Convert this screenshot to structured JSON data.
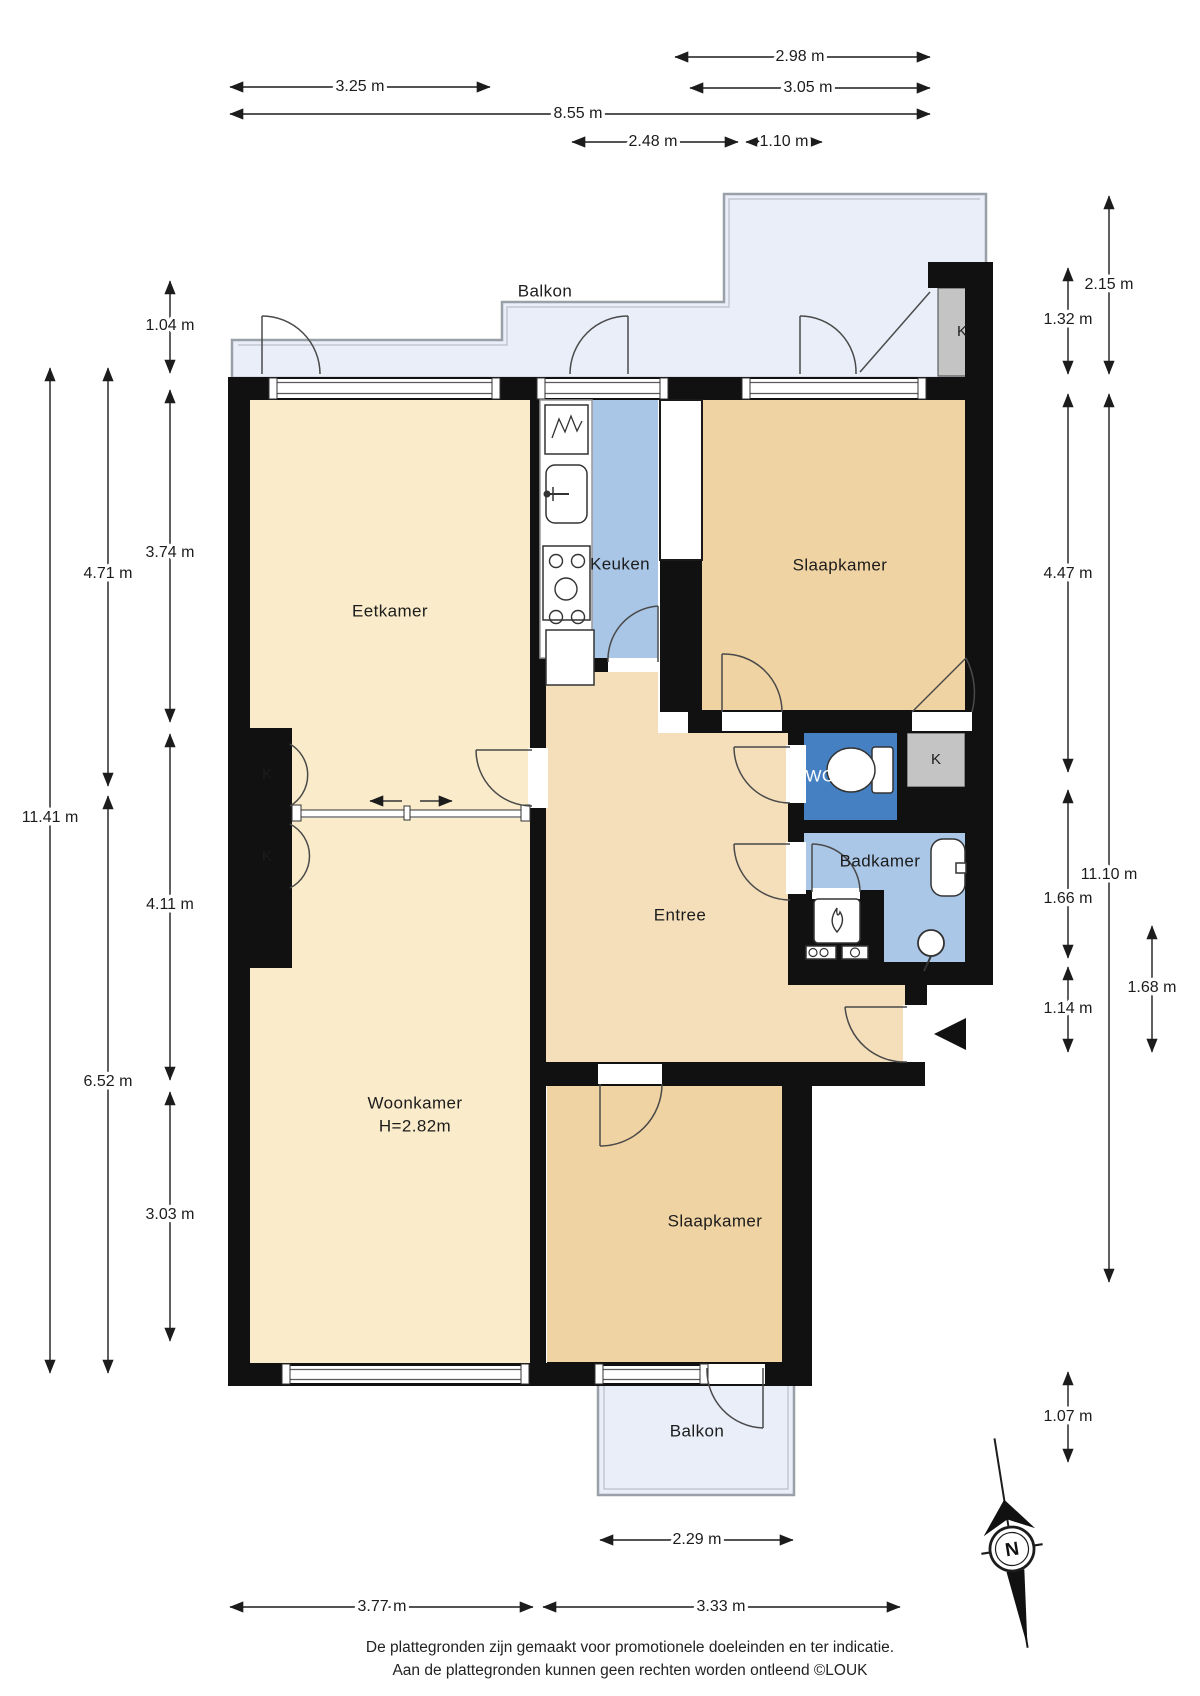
{
  "rooms": {
    "balkon_top": "Balkon",
    "eetkamer": "Eetkamer",
    "keuken": "Keuken",
    "slaapkamer_top": "Slaapkamer",
    "wc": "WC",
    "badkamer": "Badkamer",
    "entree": "Entree",
    "woonkamer": "Woonkamer",
    "woonkamer_height": "H=2.82m",
    "slaapkamer_bottom": "Slaapkamer",
    "balkon_bottom": "Balkon"
  },
  "closets": [
    "K",
    "K",
    "K",
    "K"
  ],
  "dimensions": {
    "top": [
      "2.98 m",
      "3.25 m",
      "3.05 m",
      "8.55 m",
      "2.48 m",
      "1.10 m"
    ],
    "left": [
      "1.04 m",
      "3.74 m",
      "4.71 m",
      "11.41 m",
      "4.11 m",
      "6.52 m",
      "3.03 m"
    ],
    "right": [
      "2.15 m",
      "1.32 m",
      "4.47 m",
      "11.10 m",
      "1.66 m",
      "1.14 m",
      "1.68 m",
      "1.07 m"
    ],
    "bottom": [
      "2.29 m",
      "3.77 m",
      "3.33 m"
    ]
  },
  "compass": {
    "north_label": "N"
  },
  "footer": {
    "line1": "De plattegronden zijn gemaakt voor promotionele doeleinden en ter indicatie.",
    "line2": "Aan de plattegronden kunnen geen rechten worden ontleend ©LOUK"
  },
  "colors": {
    "wall": "#111111",
    "living": "#faecca",
    "entree": "#f5dfbb",
    "bedroom": "#f0d3a2",
    "kitchen": "#a9c6e6",
    "bathroom": "#aac7e8",
    "wc": "#4581c2",
    "balcony": "#eaeef9",
    "closet": "#c4c4c4",
    "utility": "#a3a3a3"
  }
}
